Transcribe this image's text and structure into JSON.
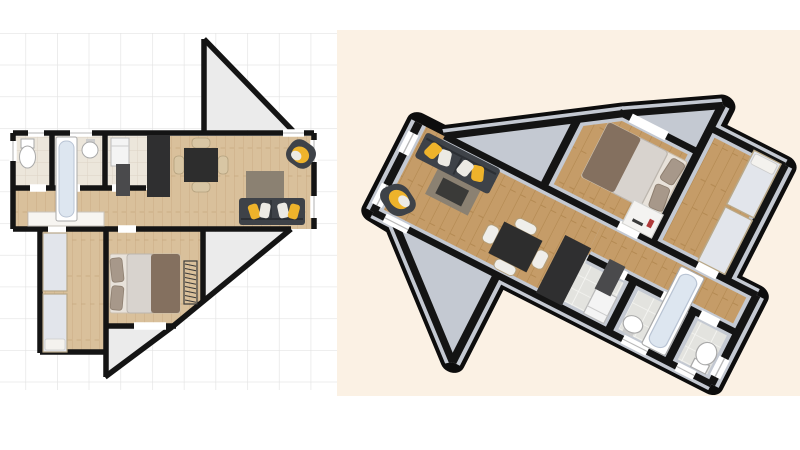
{
  "app": {
    "description": "floor-plan-editor-export",
    "views": {
      "plan2d": {
        "label": "2D floor plan view",
        "background": "grid"
      },
      "plan3d": {
        "label": "3D floor plan render view",
        "background": "cream"
      }
    }
  },
  "palette": {
    "page_bg": "#ffffff",
    "grid_line": "#e3e3e3",
    "render_bg": "#fbf1e4",
    "wall": "#141414",
    "wedge_fill": "#ebebeb",
    "wood_2d": "#d9c09b",
    "wood_grain_2d": "#c7a97f",
    "tile_2d": "#ece6db",
    "tile_line_2d": "#dcd3c4",
    "wood_3d": "#c59c68",
    "wood_grain_3d": "#b1874f",
    "tile_3d": "#e3e3df",
    "tile_line_3d": "#f5f5f2",
    "wall_gray_3d": "#c4c9d2",
    "window_gap": "#ffffff"
  },
  "furniture_colors": {
    "sofa": "#3e4248",
    "cushion_yellow": "#eeb32b",
    "cushion_white": "#eceae4",
    "rug": "#8b8172",
    "coffee_table": "#3a3a38",
    "dining_table": "#2d2d2d",
    "chair_2d": "#d8c6a4",
    "chair_3d": "#efeeea",
    "kitchen_counter": "#2f2f30",
    "cabinet_dark": "#4a4a4c",
    "appliance": "#f4f4f4",
    "bed_brown": "#84705f",
    "bed_light": "#d8d3ce",
    "bed_sheet": "#e8e2da",
    "pillow": "#a7988a",
    "unit_light": "#e2e5eb",
    "unit_edge": "#b9a888",
    "fixture": "#ffffff",
    "fixture_line": "#a9a9a9",
    "tub_inner": "#dde6f0",
    "shelf": "#f4f3f1",
    "shelf_accent": "#b03a3a",
    "radiator": "#3a3a3a",
    "sideboard": "#f7f5f1"
  },
  "scene_inventory": {
    "rooms": [
      "wc",
      "bathroom",
      "utility-kitchen",
      "living-dining-room",
      "hallway",
      "corridor",
      "bedroom"
    ],
    "furniture": [
      "toilet",
      "bathtub",
      "sink",
      "appliance",
      "kitchen-counter",
      "dining-table",
      "dining-chairs",
      "rug",
      "coffee-table",
      "sofa",
      "armchair",
      "double-bed",
      "radiator",
      "wardrobe-unit",
      "single-bed",
      "sideboard",
      "bookshelf"
    ],
    "structures": [
      "angled-wall-top-wedge",
      "angled-wall-diagonal",
      "angled-wall-bottom-wedge",
      "windows",
      "door-openings"
    ]
  }
}
